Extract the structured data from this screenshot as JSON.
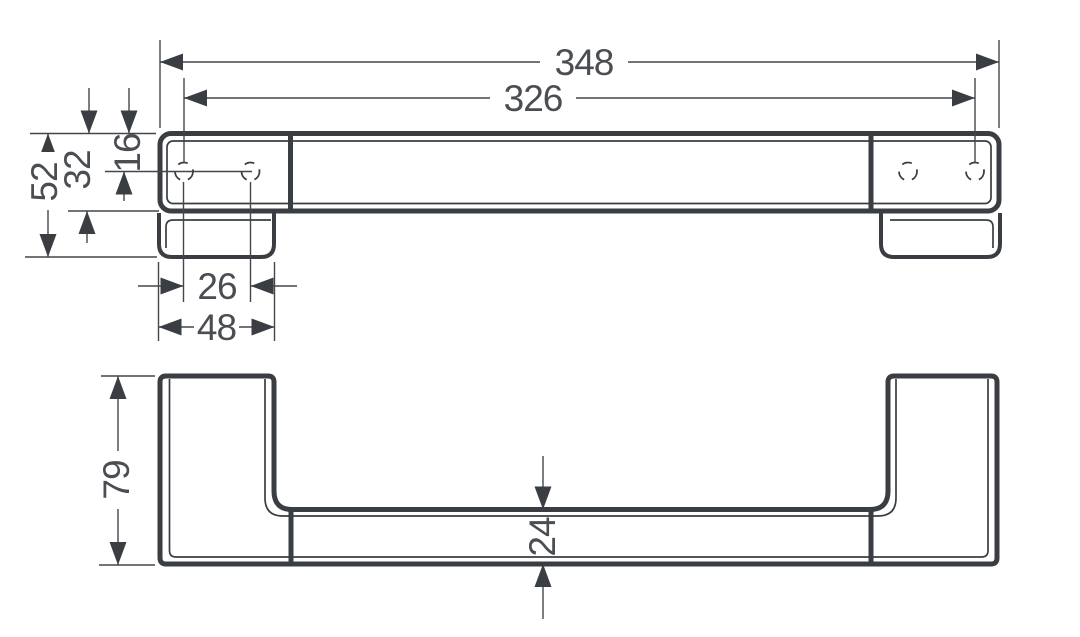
{
  "document": {
    "type": "technical-dimension-drawing",
    "subject": "wall-mounted grab bar shown in front elevation and plan view",
    "background_color": "#ffffff",
    "line_color": "#3a3e42",
    "text_color": "#4a4e53"
  },
  "views": {
    "front": {
      "name": "front-elevation"
    },
    "plan": {
      "name": "plan-view"
    }
  },
  "dims": {
    "overall_width": "348",
    "hole_spacing": "326",
    "end_height": "52",
    "bar_face_height": "32",
    "top_to_hole": "16",
    "hole_pitch": "26",
    "plate_width": "48",
    "wall_projection": "79",
    "bar_depth": "24"
  }
}
